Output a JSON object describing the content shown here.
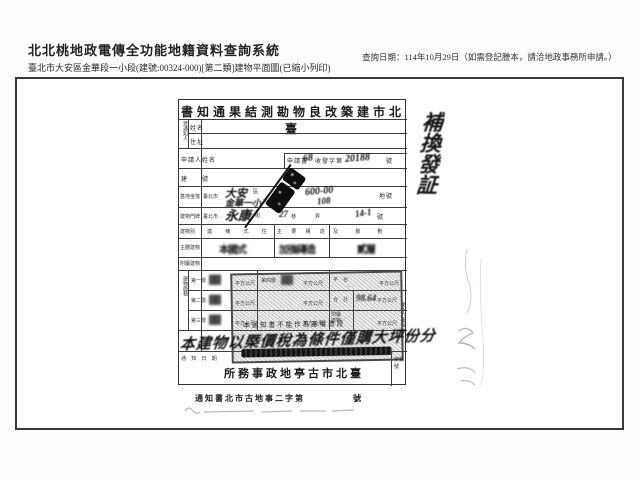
{
  "header": {
    "system_title": "北北桃地政電傳全功能地籍資料查詢系統",
    "query_date": "查詢日期：114年10月29日（如需登記謄本，請洽地政事務所申請。）",
    "parcel_info": "臺北市大安區金華段一小段(建號:00324-000)[第二類]建物平面圖(已縮小列印)"
  },
  "document": {
    "title_rtl": "書知通果結測勘物良改築建市北臺",
    "labels": {
      "recipient": "受通知人",
      "name": "姓名",
      "address": "住址",
      "applicant": "申請人姓名",
      "application": "申請書",
      "receipt_mid": "收發字第",
      "no_suffix": "號",
      "building_no": "建　　號",
      "site": "基地坐落",
      "city": "臺北市",
      "district_sfx": "區",
      "section_sfx": "段",
      "lot_sfx": "地號",
      "door_label": "建物門牌",
      "street_sfx": "街",
      "lane_sfx": "巷",
      "alley_sfx": "弄",
      "type_label": "建物別",
      "type_hdr": "連 棟 式 住",
      "structure_hdr": "主 要 構 造",
      "floors_hdr": "及 層 數",
      "main_building": "主體建物",
      "attached_building": "附屬建物",
      "area_label": "建物面積",
      "floor1": "第一層",
      "floor2": "第二層",
      "floor3": "第三層",
      "floor4": "第四層",
      "platform": "平　台",
      "total": "合　計",
      "attached2": "附屬建物",
      "sqm": "平方公尺",
      "notice_date": "通 知 日 期",
      "corner_cell": "字第號",
      "sheet_vertical": "第十六圖幅",
      "disclaimer": "本通知書不能作為產權憑證",
      "office_rtl": "所務事政地亭古市北臺",
      "footer_line": "通知書北市古地事二字第",
      "footer_no": "號"
    },
    "handwriting": {
      "margin_note": "補換發証",
      "receipt_prefix": "68",
      "receipt_no": "20188",
      "district": "大安",
      "section": "金華一小",
      "lot_no": "600-00",
      "lot_no2": "108",
      "street": "永康",
      "lane_no": "27",
      "house_no": "14-1",
      "style": "本國式",
      "structure": "加強磚造",
      "floors": "貳層",
      "floor1_area": "▓▓",
      "floor4_area": "▓▓",
      "floor2_area": "▓▓",
      "floor3_area": "▓▓",
      "total_area": "98.64",
      "note_line": "本建物以㮣價稅為條件僅購大坪份分"
    },
    "stamps": {
      "ink_stamp": "illegible-black-diagonal-stamp",
      "gray_box_stamp": "dotted-registration-stamp"
    }
  }
}
